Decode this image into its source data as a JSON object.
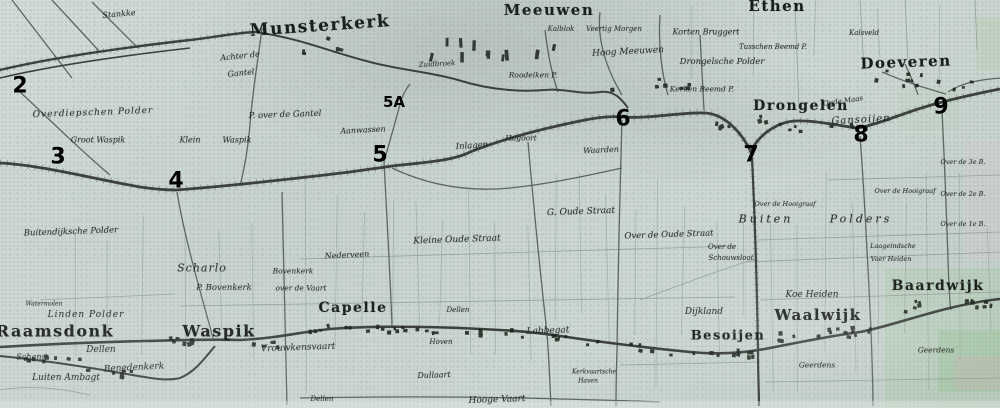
{
  "map": {
    "description": "Scanned 19th-century topographic map of the Langstraat region (Netherlands) with bold numeric overlay markers",
    "palette": {
      "paper": "#cbd6d2",
      "ink": "#23271f",
      "line_thin": "#98a7a2",
      "line_road": "#5d6762",
      "line_dike": "#3c413e",
      "buildings": "#1d211c",
      "tint_green": "#9fc79b",
      "tint_pink": "#d9a8bc"
    }
  },
  "towns": [
    {
      "t": "Munsterkerk",
      "x": 320,
      "y": 26,
      "s": 17,
      "r": -4
    },
    {
      "t": "Meeuwen",
      "x": 549,
      "y": 10,
      "s": 15,
      "r": 0
    },
    {
      "t": "Ethen",
      "x": 777,
      "y": 6,
      "s": 15,
      "r": 0
    },
    {
      "t": "Doeveren",
      "x": 906,
      "y": 62,
      "s": 15,
      "r": -2
    },
    {
      "t": "Drongelen",
      "x": 801,
      "y": 106,
      "s": 14,
      "r": 0
    },
    {
      "t": "Raamsdonk",
      "x": 55,
      "y": 331,
      "s": 16,
      "r": 0
    },
    {
      "t": "Waspik",
      "x": 219,
      "y": 331,
      "s": 16,
      "r": 0
    },
    {
      "t": "Capelle",
      "x": 353,
      "y": 308,
      "s": 14,
      "r": 0
    },
    {
      "t": "Besoijen",
      "x": 728,
      "y": 336,
      "s": 13,
      "r": 0
    },
    {
      "t": "Waalwijk",
      "x": 818,
      "y": 315,
      "s": 15,
      "r": 0
    },
    {
      "t": "Baardwijk",
      "x": 938,
      "y": 286,
      "s": 14,
      "r": 0
    }
  ],
  "labels": [
    {
      "t": "Stankke",
      "x": 119,
      "y": 14,
      "s": 8,
      "r": -5,
      "ls": 0
    },
    {
      "t": "Overdiepschen Polder",
      "x": 93,
      "y": 113,
      "s": 9,
      "r": -2,
      "ls": 1
    },
    {
      "t": "Groot Waspik",
      "x": 98,
      "y": 140,
      "s": 8,
      "r": 0,
      "ls": 0
    },
    {
      "t": "Klein",
      "x": 190,
      "y": 140,
      "s": 8,
      "r": 0,
      "ls": 0
    },
    {
      "t": "Waspik",
      "x": 237,
      "y": 140,
      "s": 8,
      "r": 0,
      "ls": 0
    },
    {
      "t": "Achter de",
      "x": 240,
      "y": 56,
      "s": 8,
      "r": -6,
      "ls": 0
    },
    {
      "t": "Gantel",
      "x": 241,
      "y": 73,
      "s": 8,
      "r": -6,
      "ls": 0
    },
    {
      "t": "P. over de Gantel",
      "x": 285,
      "y": 115,
      "s": 8.5,
      "r": -2,
      "ls": 0
    },
    {
      "t": "Aanwassen",
      "x": 363,
      "y": 130,
      "s": 8,
      "r": -3,
      "ls": 0
    },
    {
      "t": "Zuidbroek",
      "x": 437,
      "y": 64,
      "s": 7,
      "r": -3,
      "ls": 0
    },
    {
      "t": "Inlagen",
      "x": 472,
      "y": 146,
      "s": 8.5,
      "r": -4,
      "ls": 0
    },
    {
      "t": "Hagoort",
      "x": 521,
      "y": 138,
      "s": 7.5,
      "r": 0,
      "ls": 0
    },
    {
      "t": "Waarden",
      "x": 601,
      "y": 150,
      "s": 8,
      "r": -3,
      "ls": 0
    },
    {
      "t": "Kalblok",
      "x": 561,
      "y": 29,
      "s": 7,
      "r": 0,
      "ls": 0
    },
    {
      "t": "Veertig Morgen",
      "x": 614,
      "y": 29,
      "s": 7,
      "r": 0,
      "ls": 0
    },
    {
      "t": "Hoog Meeuwen",
      "x": 628,
      "y": 52,
      "s": 9,
      "r": -3,
      "ls": 0
    },
    {
      "t": "Roodeiken P.",
      "x": 533,
      "y": 75,
      "s": 7.5,
      "r": 0,
      "ls": 0
    },
    {
      "t": "Korten Bruggert",
      "x": 706,
      "y": 32,
      "s": 8,
      "r": 0,
      "ls": 0
    },
    {
      "t": "Tusschen Beemd P.",
      "x": 773,
      "y": 47,
      "s": 7,
      "r": 0,
      "ls": 0
    },
    {
      "t": "Drongelsche Polder",
      "x": 722,
      "y": 62,
      "s": 8.5,
      "r": 0,
      "ls": 0
    },
    {
      "t": "Kerken Beemd P.",
      "x": 702,
      "y": 89,
      "s": 7.5,
      "r": 0,
      "ls": 0
    },
    {
      "t": "Kalsveld",
      "x": 864,
      "y": 33,
      "s": 7,
      "r": 0,
      "ls": 0
    },
    {
      "t": "Oude Maas",
      "x": 843,
      "y": 101,
      "s": 7,
      "r": -8,
      "ls": 0
    },
    {
      "t": "Gansoijen",
      "x": 861,
      "y": 120,
      "s": 10,
      "r": -3,
      "ls": 1
    },
    {
      "t": "Buitendijksche Polder",
      "x": 71,
      "y": 232,
      "s": 8.5,
      "r": -2,
      "ls": 0
    },
    {
      "t": "Scharlo",
      "x": 202,
      "y": 268,
      "s": 11,
      "r": 0,
      "ls": 1
    },
    {
      "t": "P. Bovenkerk",
      "x": 224,
      "y": 288,
      "s": 8.5,
      "r": 0,
      "ls": 0
    },
    {
      "t": "Bovenkerk",
      "x": 293,
      "y": 271,
      "s": 7.5,
      "r": 0,
      "ls": 0
    },
    {
      "t": "over de Vaart",
      "x": 301,
      "y": 288,
      "s": 7.5,
      "r": 0,
      "ls": 0
    },
    {
      "t": "Nederveen",
      "x": 347,
      "y": 255,
      "s": 8,
      "r": -3,
      "ls": 0
    },
    {
      "t": "Kleine Oude Straat",
      "x": 457,
      "y": 240,
      "s": 9,
      "r": -2,
      "ls": 0
    },
    {
      "t": "G. Oude Straat",
      "x": 581,
      "y": 212,
      "s": 9,
      "r": -2,
      "ls": 0
    },
    {
      "t": "Over de Oude Straat",
      "x": 669,
      "y": 235,
      "s": 8.5,
      "r": -2,
      "ls": 0
    },
    {
      "t": "Over de",
      "x": 722,
      "y": 247,
      "s": 7,
      "r": 0,
      "ls": 0
    },
    {
      "t": "Schouwsloot",
      "x": 731,
      "y": 258,
      "s": 7,
      "r": 0,
      "ls": 0
    },
    {
      "t": "Linden Polder",
      "x": 86,
      "y": 315,
      "s": 9,
      "r": 0,
      "ls": 1
    },
    {
      "t": "Watermolen",
      "x": 44,
      "y": 304,
      "s": 6,
      "r": 0,
      "ls": 0
    },
    {
      "t": "Dellen",
      "x": 101,
      "y": 350,
      "s": 9,
      "r": 0,
      "ls": 0
    },
    {
      "t": "Schans",
      "x": 31,
      "y": 357,
      "s": 8,
      "r": 0,
      "ls": 0
    },
    {
      "t": "Benedenkerk",
      "x": 134,
      "y": 368,
      "s": 9,
      "r": -3,
      "ls": 0
    },
    {
      "t": "Luiten Ambagt",
      "x": 66,
      "y": 378,
      "s": 9,
      "r": 0,
      "ls": 0
    },
    {
      "t": "Vrouwkensvaart",
      "x": 298,
      "y": 348,
      "s": 9,
      "r": -2,
      "ls": 0
    },
    {
      "t": "Dellen",
      "x": 458,
      "y": 310,
      "s": 7,
      "r": 0,
      "ls": 0
    },
    {
      "t": "Dellen",
      "x": 322,
      "y": 399,
      "s": 7,
      "r": 0,
      "ls": 0
    },
    {
      "t": "Hoven",
      "x": 441,
      "y": 342,
      "s": 7,
      "r": 0,
      "ls": 0
    },
    {
      "t": "Dullaart",
      "x": 434,
      "y": 375,
      "s": 8,
      "r": -2,
      "ls": 0
    },
    {
      "t": "Hooge Vaart",
      "x": 497,
      "y": 400,
      "s": 9,
      "r": -2,
      "ls": 0
    },
    {
      "t": "Labbegat",
      "x": 548,
      "y": 331,
      "s": 9,
      "r": -2,
      "ls": 0
    },
    {
      "t": "Kerkvaartsche",
      "x": 594,
      "y": 372,
      "s": 6,
      "r": 0,
      "ls": 0
    },
    {
      "t": "Haven",
      "x": 588,
      "y": 381,
      "s": 6,
      "r": 0,
      "ls": 0
    },
    {
      "t": "Dijkland",
      "x": 704,
      "y": 312,
      "s": 9,
      "r": 0,
      "ls": 0
    },
    {
      "t": "Koe Heiden",
      "x": 812,
      "y": 295,
      "s": 9,
      "r": 0,
      "ls": 0
    },
    {
      "t": "Buiten",
      "x": 766,
      "y": 219,
      "s": 11,
      "r": 0,
      "ls": 3
    },
    {
      "t": "Polders",
      "x": 861,
      "y": 219,
      "s": 11,
      "r": 0,
      "ls": 3
    },
    {
      "t": "Over de Hooigraaf",
      "x": 785,
      "y": 204,
      "s": 6.5,
      "r": 0,
      "ls": 0
    },
    {
      "t": "Over de Hooigraaf",
      "x": 905,
      "y": 191,
      "s": 6.5,
      "r": 0,
      "ls": 0
    },
    {
      "t": "Laageindsche",
      "x": 893,
      "y": 246,
      "s": 6.5,
      "r": 0,
      "ls": 0
    },
    {
      "t": "Vaer Heiden",
      "x": 891,
      "y": 259,
      "s": 6.5,
      "r": 0,
      "ls": 0
    },
    {
      "t": "Geerdens",
      "x": 817,
      "y": 365,
      "s": 7.5,
      "r": 0,
      "ls": 0
    },
    {
      "t": "Geerdens",
      "x": 936,
      "y": 350,
      "s": 7.5,
      "r": 0,
      "ls": 0
    },
    {
      "t": "Over de 3e B.",
      "x": 963,
      "y": 162,
      "s": 6.5,
      "r": 0,
      "ls": 0
    },
    {
      "t": "Over de 2e B.",
      "x": 963,
      "y": 194,
      "s": 6.5,
      "r": 0,
      "ls": 0
    },
    {
      "t": "Over de 1e B.",
      "x": 963,
      "y": 224,
      "s": 6.5,
      "r": 0,
      "ls": 0
    }
  ],
  "annotations": [
    {
      "t": "2",
      "x": 20,
      "y": 86,
      "s": 22
    },
    {
      "t": "3",
      "x": 58,
      "y": 157,
      "s": 22
    },
    {
      "t": "4",
      "x": 176,
      "y": 181,
      "s": 22
    },
    {
      "t": "5",
      "x": 380,
      "y": 155,
      "s": 22
    },
    {
      "t": "5A",
      "x": 394,
      "y": 102,
      "s": 15
    },
    {
      "t": "6",
      "x": 623,
      "y": 119,
      "s": 22
    },
    {
      "t": "7",
      "x": 751,
      "y": 155,
      "s": 22
    },
    {
      "t": "8",
      "x": 861,
      "y": 135,
      "s": 22
    },
    {
      "t": "9",
      "x": 941,
      "y": 107,
      "s": 22
    }
  ]
}
